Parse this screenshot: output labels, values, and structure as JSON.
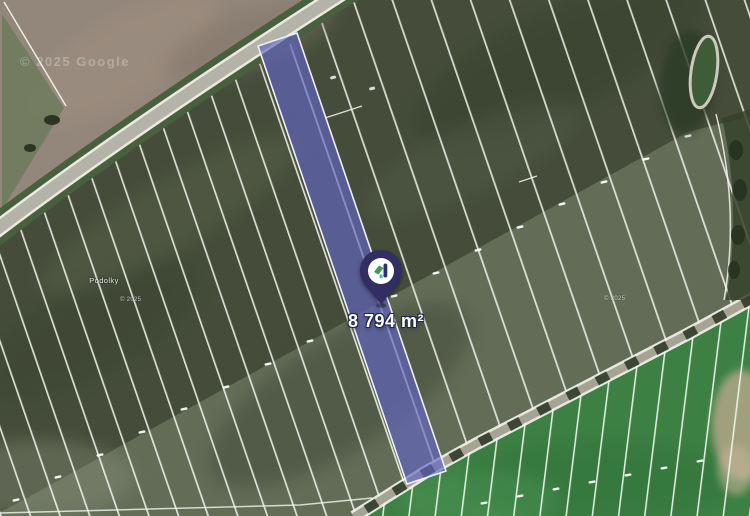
{
  "map": {
    "area_label": "8 794 m²",
    "place_label": "Podolky",
    "attribution": "© 2025 Google",
    "watermark_small": "© 2025"
  },
  "colors": {
    "field_dark": "#454d3a",
    "field_sage": "#7b8670",
    "field_green": "#3d8044",
    "field_brown": "#93867b",
    "road_asphalt": "#b4b3a7",
    "boundary_line": "#f4f6ee",
    "parcel_highlight_fill": "rgba(99,102,196,0.65)",
    "parcel_highlight_stroke": "#eef0fa",
    "pin_body": "#322e63",
    "pin_icon_green": "#3f9e4d",
    "pin_icon_navy": "#2d3076",
    "pin_icon_teal": "#53b7c9"
  }
}
